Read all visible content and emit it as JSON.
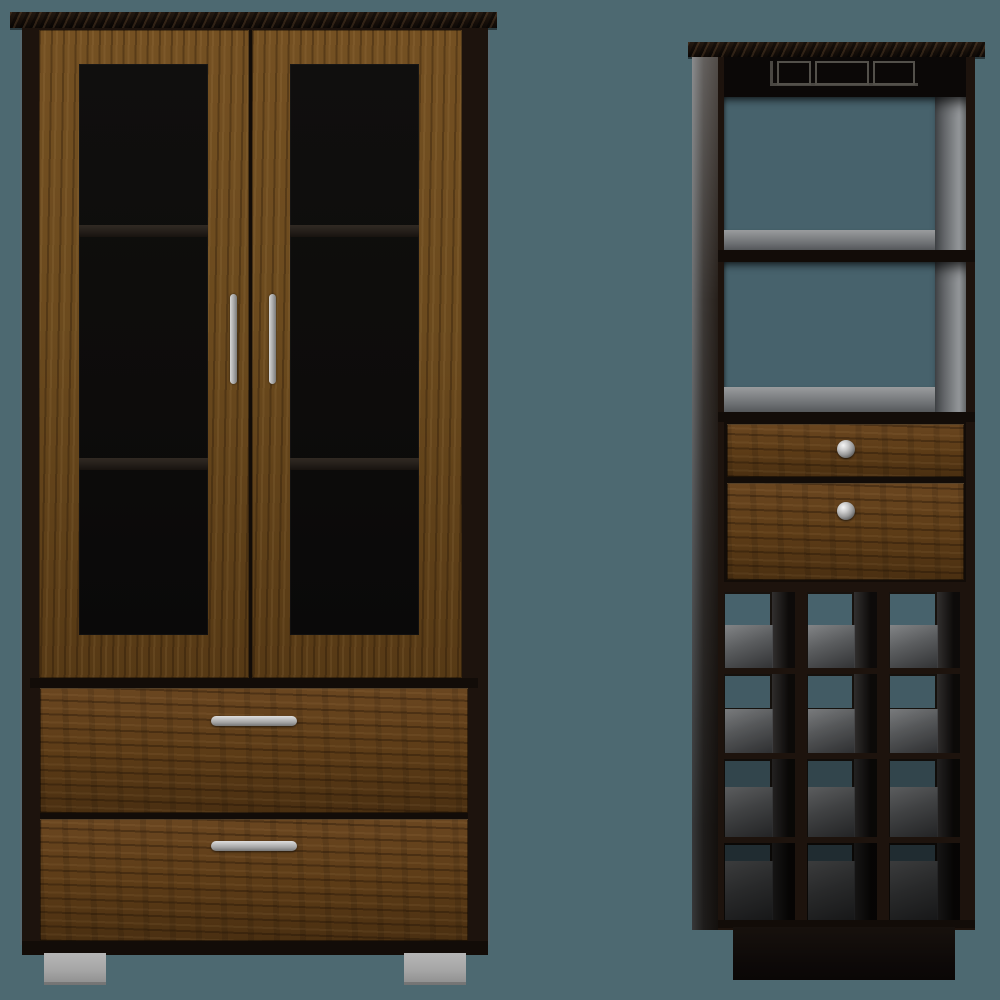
{
  "scene": {
    "type": "furniture product render, two-piece set on plain backdrop",
    "background_color": "#4d6971",
    "items": [
      {
        "id": "armoire",
        "label": "Two-door glass armoire with two bottom drawers",
        "finish": {
          "frame": "dark espresso",
          "doors": "walnut",
          "drawers": "rustic walnut"
        },
        "glass_doors": 2,
        "interior_shelves_visible": 2,
        "door_handles": {
          "count": 2,
          "style": "vertical chrome bar"
        },
        "drawers": {
          "count": 2,
          "handle_style": "horizontal chrome bar"
        },
        "feet": {
          "count": 2,
          "style": "square chrome glide"
        }
      },
      {
        "id": "bar_cabinet",
        "label": "Bar cabinet wine tower",
        "finish": {
          "frame": "black espresso",
          "drawers": "walnut",
          "interior": "gray"
        },
        "stemware_rack": {
          "present": true,
          "slots": 3
        },
        "open_shelves": 2,
        "drawers": {
          "count": 2,
          "knob_style": "round chrome"
        },
        "wine_cubbies": {
          "rows": 4,
          "columns": 3,
          "count": 12,
          "row_back_heights_pct": [
            41,
            41,
            33,
            20
          ],
          "row_brightness": [
            1,
            0.93,
            0.7,
            0.45
          ]
        },
        "base": "recessed plinth"
      }
    ]
  },
  "colors": {
    "background": "#4d6971",
    "back_opening": "#47626c",
    "espresso": "#1d130d",
    "espresso_deep": "#120c08",
    "crown": "#18100a",
    "walnut": "#6b4a1e",
    "walnut_dark": "#4f3414",
    "drawer_wood": "#5d3c17",
    "glass": "#0d0c0b",
    "shelf_line": "#2a241e",
    "chrome_light": "#d9d9d9",
    "chrome_mid": "#a8a8a8",
    "chrome_dark": "#6e6e6e",
    "foot_gray": "#a5a5a5",
    "interior_gray_light": "#94979a",
    "interior_gray": "#6b6e71",
    "interior_gray_dark": "#3c3e40",
    "side_panel_light": "#5a5c5e",
    "side_panel_dark": "#1a1411"
  }
}
